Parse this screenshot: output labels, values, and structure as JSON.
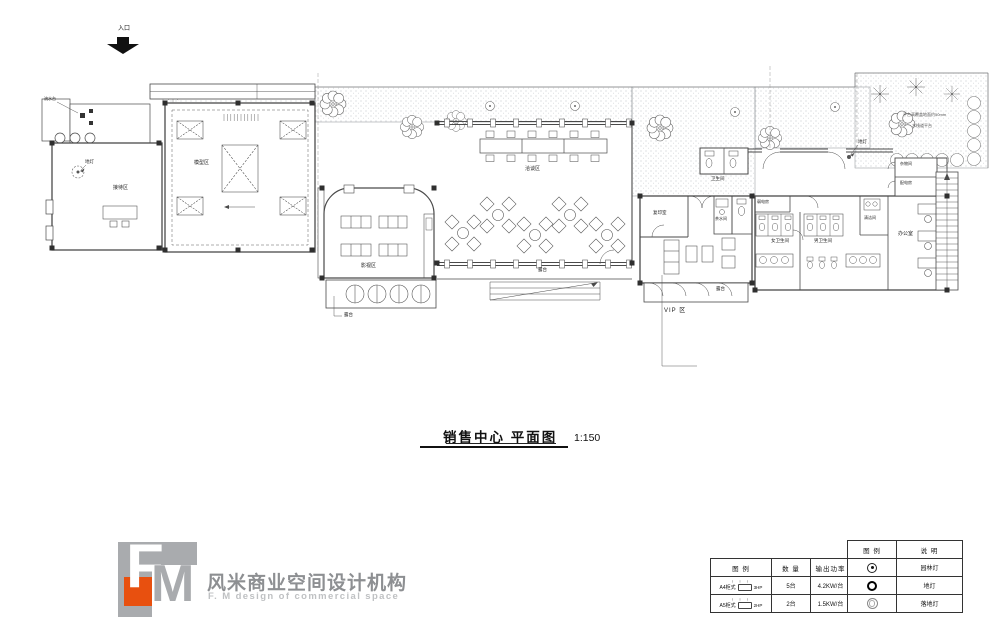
{
  "plan": {
    "entrance": "入口",
    "terrace": "露台",
    "rooms": {
      "reception": "接待区",
      "model": "模型区",
      "video": "影视区",
      "negotiation": "洽谈区",
      "vip": "VIP 区",
      "restroom": "卫生间",
      "copy_room": "复印室",
      "tea_room": "茶水间",
      "low_voltage": "弱电房",
      "women_restroom": "女卫生间",
      "men_restroom": "男卫生间",
      "cleaning": "清洁间",
      "storage": "杂物间",
      "power_dist": "配电房",
      "office": "办公室"
    },
    "annotations": {
      "water_feature": "流水台",
      "ground_light": "地灯",
      "note_line1": "平台高覆盖地面约50mm",
      "note_line2": "木栈道平台"
    }
  },
  "title": {
    "text": "销售中心 平面图",
    "scale": "1:150"
  },
  "logo": {
    "f": "F",
    "m": "M",
    "cn": "风米商业空间设计机构",
    "en": "F. M design of commercial space",
    "orange": "#e8500f",
    "gray": "#a9abae"
  },
  "legend_power": {
    "headers": [
      "图 例",
      "数 量",
      "输出功率"
    ],
    "rows": [
      {
        "arrows": "↑ ↑ ↑",
        "model": "A4柜式",
        "hp": "3HP",
        "qty": "5台",
        "power": "4.2KW/台"
      },
      {
        "arrows": "↑ ↑ ↑",
        "model": "A5柜式",
        "hp": "2HP",
        "qty": "2台",
        "power": "1.5KW/台"
      }
    ]
  },
  "legend_lights": {
    "headers": [
      "图 例",
      "说 明"
    ],
    "rows": [
      {
        "symbol": "garden-light",
        "desc": "园林灯"
      },
      {
        "symbol": "ground-light",
        "desc": "地灯"
      },
      {
        "symbol": "floor-lamp",
        "desc": "落地灯"
      }
    ]
  }
}
